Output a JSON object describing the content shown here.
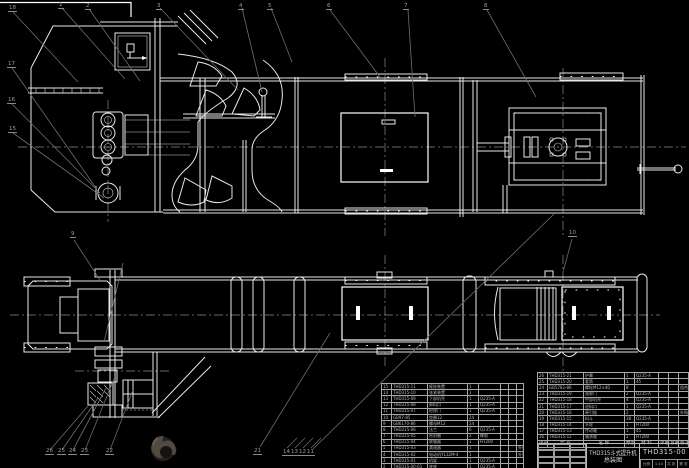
{
  "titleblock": {
    "product": "THD315斗式提升机",
    "sheet_name": "总装图",
    "drawing_no": "THD315-00",
    "meta_cells": [
      "比例",
      "1:10",
      "共 张",
      "第 张"
    ]
  },
  "bom_header": [
    "序号",
    "代 号",
    "名 称",
    "数量",
    "材 料",
    "单重",
    "总重",
    "备注"
  ],
  "bom_right_rows": [
    [
      "26",
      "THD315-21",
      "护罩",
      "1",
      "Q235-A",
      "",
      "",
      ""
    ],
    [
      "25",
      "THD315-20",
      "套筒",
      "1",
      "45",
      "",
      "",
      ""
    ],
    [
      "24",
      "GB5782-86",
      "螺栓M12×40",
      "8",
      "",
      "",
      "",
      "组合"
    ],
    [
      "23",
      "THD315-19",
      "观察门",
      "2",
      "Q235-A",
      "",
      "",
      ""
    ],
    [
      "22",
      "THD315-18",
      "中部机壳",
      "4",
      "Q235-A",
      "",
      "",
      ""
    ],
    [
      "21",
      "THD315-17",
      "进料口",
      "1",
      "Q235-A",
      "",
      "",
      ""
    ],
    [
      "20",
      "THD315-16",
      "牵引链",
      "2",
      "",
      "",
      "",
      "外购"
    ],
    [
      "19",
      "THD315-15",
      "料斗",
      "38",
      "Q235-A",
      "",
      "",
      ""
    ],
    [
      "18",
      "THD315-14",
      "头轮",
      "1",
      "HT200",
      "",
      "",
      ""
    ],
    [
      "17",
      "THD315-13",
      "传动轴",
      "1",
      "45",
      "",
      "",
      ""
    ],
    [
      "16",
      "THD315-12",
      "轴承座",
      "2",
      "HT200",
      "",
      "",
      ""
    ]
  ],
  "bom_left_rows": [
    [
      "15",
      "THD315-11",
      "尾轮装置",
      "1",
      "",
      "",
      "",
      ""
    ],
    [
      "14",
      "THD315-10",
      "张紧装置",
      "1",
      "",
      "",
      "",
      ""
    ],
    [
      "13",
      "THD315-09",
      "下部机壳",
      "1",
      "Q235-A",
      "",
      "",
      ""
    ],
    [
      "12",
      "THD315-08",
      "卸料口",
      "1",
      "Q235-A",
      "",
      "",
      ""
    ],
    [
      "11",
      "THD315-07",
      "检修门",
      "1",
      "Q235-A",
      "",
      "",
      ""
    ],
    [
      "10",
      "GB97-85",
      "垫圈12",
      "24",
      "",
      "",
      "",
      ""
    ],
    [
      "9",
      "GB6170-86",
      "螺母M12",
      "24",
      "",
      "",
      "",
      ""
    ],
    [
      "8",
      "THD315-06",
      "法兰",
      "6",
      "Q235-A",
      "",
      "",
      ""
    ],
    [
      "7",
      "THD315-05",
      "密封圈",
      "2",
      "橡胶",
      "",
      "",
      ""
    ],
    [
      "6",
      "THD315-04",
      "联轴器",
      "1",
      "HT200",
      "",
      "",
      ""
    ],
    [
      "5",
      "THD315-03",
      "减速器",
      "1",
      "",
      "",
      "",
      "外购"
    ],
    [
      "4",
      "THD315-02",
      "电动机Y132M-4",
      "1",
      "",
      "",
      "",
      "外购"
    ],
    [
      "3",
      "THD315-01",
      "机架",
      "1",
      "Q235-A",
      "",
      "",
      ""
    ],
    [
      "2",
      "THD315-00-01",
      "底座",
      "1",
      "Q235-A",
      "",
      "",
      ""
    ]
  ],
  "balloons": [
    "18",
    "1",
    "2",
    "3",
    "4",
    "5",
    "6",
    "7",
    "8",
    "17",
    "16",
    "15",
    "9",
    "10",
    "26",
    "25",
    "24",
    "23",
    "22",
    "21",
    "14",
    "13",
    "12",
    "11"
  ]
}
